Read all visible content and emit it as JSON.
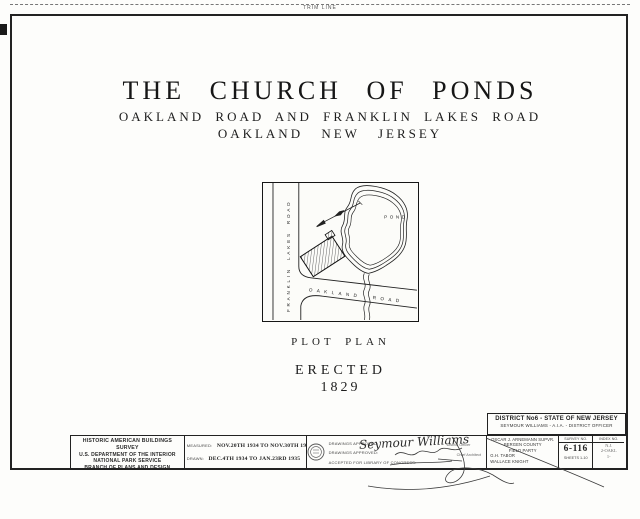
{
  "page": {
    "trim_line_label": "TRIM LINE",
    "title": "THE CHURCH OF PONDS",
    "subtitle_line1": "OAKLAND ROAD AND FRANKLIN LAKES ROAD",
    "subtitle_line2": "OAKLAND NEW JERSEY",
    "plot_plan_caption": "PLOT PLAN",
    "erected_label": "ERECTED",
    "erected_year": "1829"
  },
  "plot_plan": {
    "vertical_road_label": "FRANKLIN LAKES ROAD",
    "diagonal_road_label": "OAKLAND ROAD",
    "pond_label": "POND"
  },
  "title_block": {
    "agency": {
      "line1": "HISTORIC AMERICAN BUILDINGS SURVEY",
      "line2": "U.S. DEPARTMENT OF THE INTERIOR",
      "line3": "NATIONAL PARK SERVICE",
      "line4": "BRANCH OF PLANS AND DESIGN"
    },
    "dates": {
      "measured_label": "MEASURED:",
      "measured_value": "NOV.20TH 1934 TO NOV.30TH 1934",
      "drawn_label": "DRAWN:",
      "drawn_value": "DEC.4TH 1934 TO JAN.23RD 1935",
      "checked_label": "MEASUREMENTS CHECKED:"
    },
    "approvals": {
      "row1_label": "DRAWINGS APPROVED:",
      "row1_signature": "Seymour Williams",
      "row1_note": "District Officer",
      "row2_label": "DRAWINGS APPROVED:",
      "row2_note": "Chief Architect",
      "row3_label": "ACCEPTED FOR LIBRARY OF CONGRESS:"
    },
    "district": {
      "header_line1": "DISTRICT No6 - STATE OF NEW JERSEY",
      "header_line2": "SEYMOUR WILLIAMS - A.I.A. - DISTRICT OFFICER",
      "personnel": [
        "OSCAR J. ARNEMANN SUPVR.",
        "BERGEN COUNTY",
        "FIELD PARTY",
        "G.H. TABOR",
        "WALLACE KNIGHT"
      ],
      "survey_label": "SURVEY NO.",
      "survey_no": "6-116",
      "sheets_label": "SHEETS 1-10",
      "index_label": "INDEX NO.",
      "index_lines": [
        "N.J.",
        "2-OAKL",
        "1-"
      ]
    }
  },
  "colors": {
    "ink": "#1d1d1d",
    "paper": "#fdfdfb"
  }
}
